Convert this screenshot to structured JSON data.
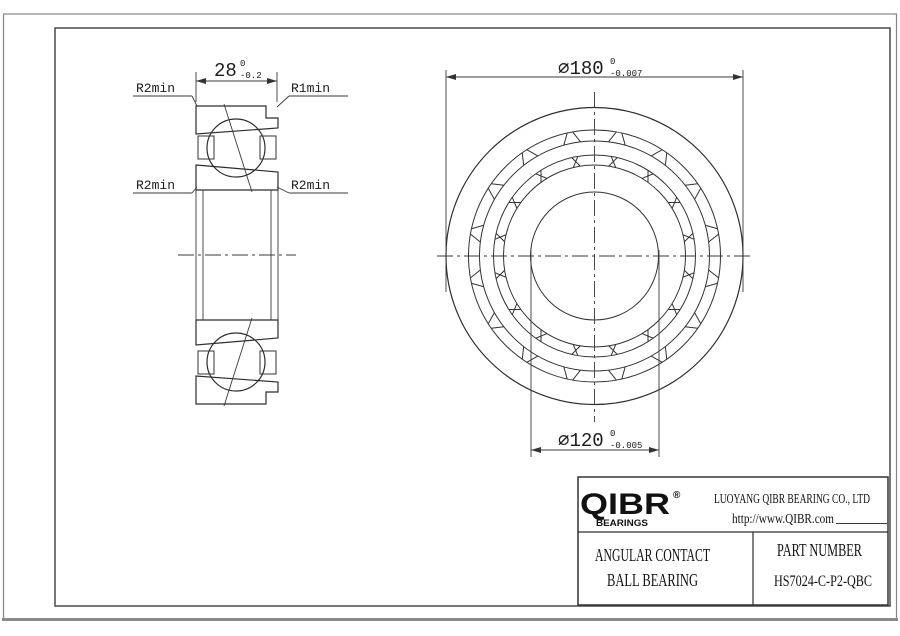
{
  "colors": {
    "line": "#333333",
    "frame": "#4a4a4a",
    "sheet_edge": "#8a8a8a",
    "text": "#111111"
  },
  "section_view": {
    "labels": {
      "top_left": "R2min",
      "top_right": "R1min",
      "mid_left": "R2min",
      "mid_right": "R2min"
    },
    "width_dim": {
      "value": "28",
      "tol_upper": "0",
      "tol_lower": "-0.2"
    }
  },
  "front_view": {
    "outer_dim": {
      "value": "⌀180",
      "tol_upper": "0",
      "tol_lower": "-0.007"
    },
    "bore_dim": {
      "value": "⌀120",
      "tol_upper": "0",
      "tol_lower": "-0.005"
    }
  },
  "title_block": {
    "logo": {
      "name": "QIBR",
      "registered": "®",
      "subtitle": "BEARINGS"
    },
    "company": "LUOYANG QIBR BEARING CO., LTD",
    "website": "http://www.QIBR.com",
    "product": {
      "line1": "ANGULAR CONTACT",
      "line2": "BALL BEARING"
    },
    "part": {
      "label": "PART NUMBER",
      "number": "HS7024-C-P2-QBC"
    }
  }
}
